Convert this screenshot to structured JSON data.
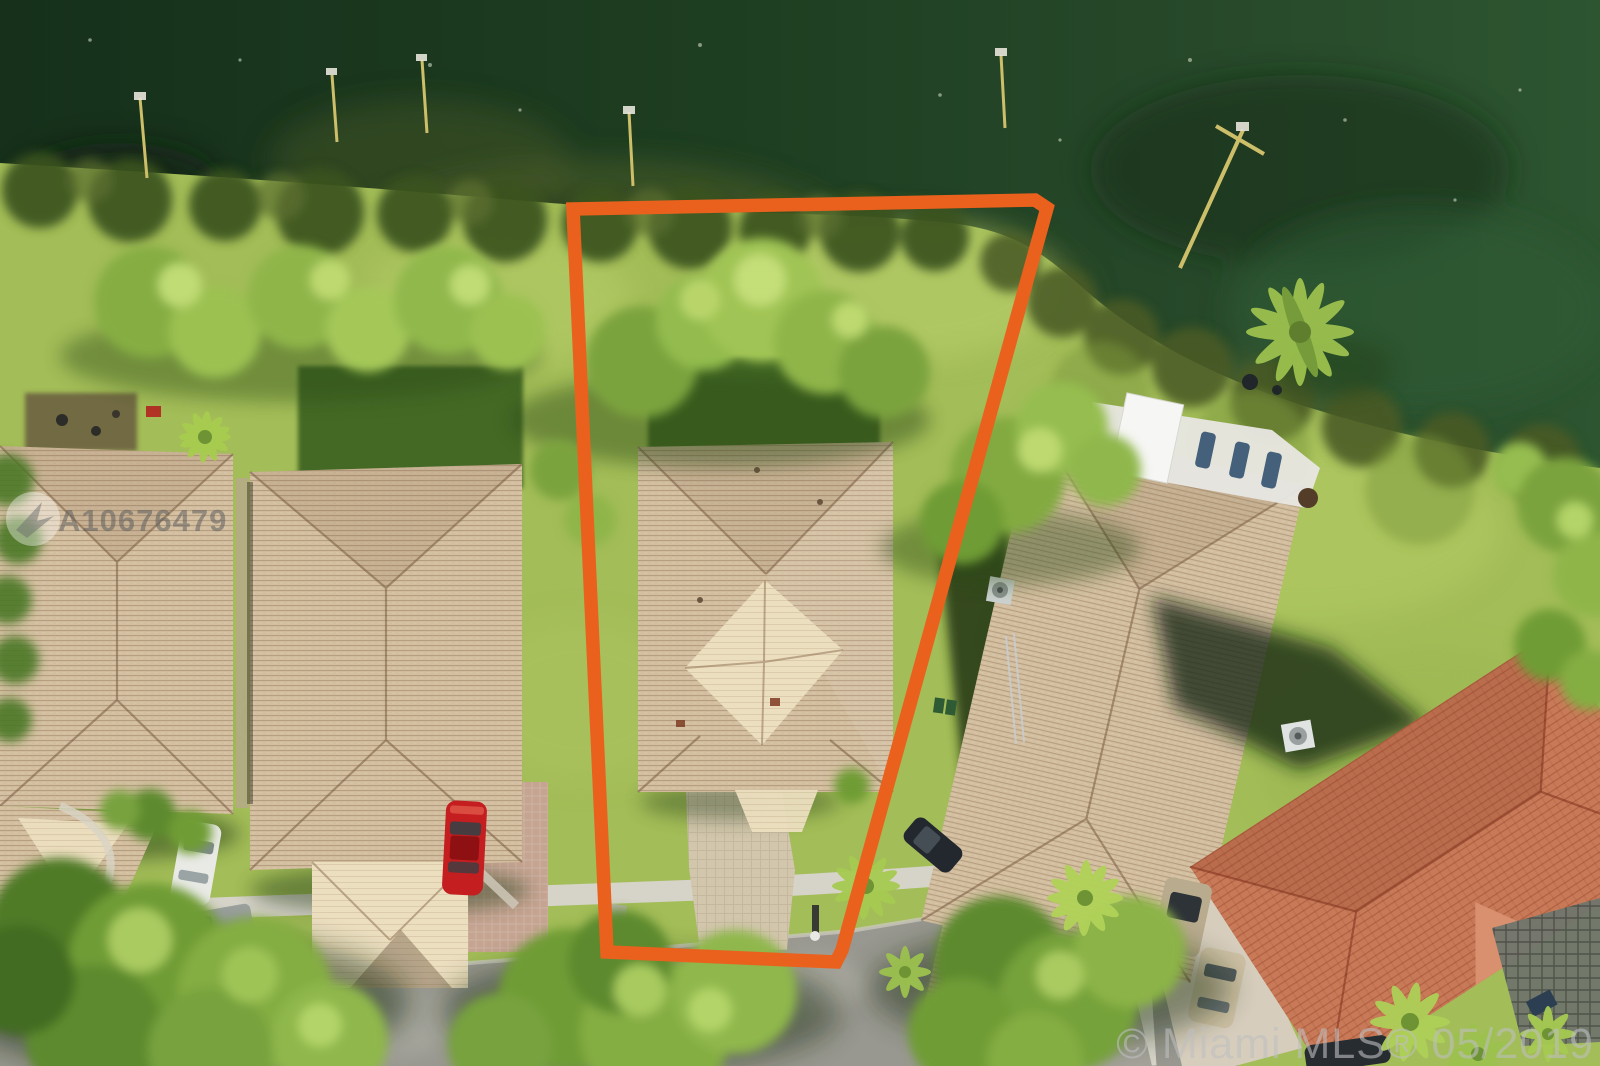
{
  "meta": {
    "type": "aerial-drone-photo",
    "description": "Overhead aerial photo of a lakefront residential lot outlined in orange, tan tile-roof houses along a curving street"
  },
  "watermarks": {
    "listing_id": "A10676479",
    "mls_credit": "© Miami MLS® 05/2019"
  },
  "annotation": {
    "lot_outline_color": "#EA611E"
  },
  "palette": {
    "water_deep": "#17321c",
    "water_mid": "#234725",
    "water_light": "#2d5530",
    "algae_olive": "#57652e",
    "grass_bright": "#a3bd58",
    "grass_sunlit": "#b8cf6a",
    "grass_dark_lawn": "#3e6423",
    "roof_tan": "#d3bfa0",
    "roof_cream": "#ecdfc0",
    "roof_terracotta": "#c87a58",
    "road_asphalt": "#999890",
    "sidewalk": "#d6d3c8",
    "car_red": "#c41e20"
  },
  "scene": {
    "water_body": "lake at top",
    "outlined_lot": "trapezoidal lot with tan hip-roof house and driveway",
    "houses_visible": 5,
    "cars_visible": 7,
    "flag_poles_on_shore": 6
  }
}
